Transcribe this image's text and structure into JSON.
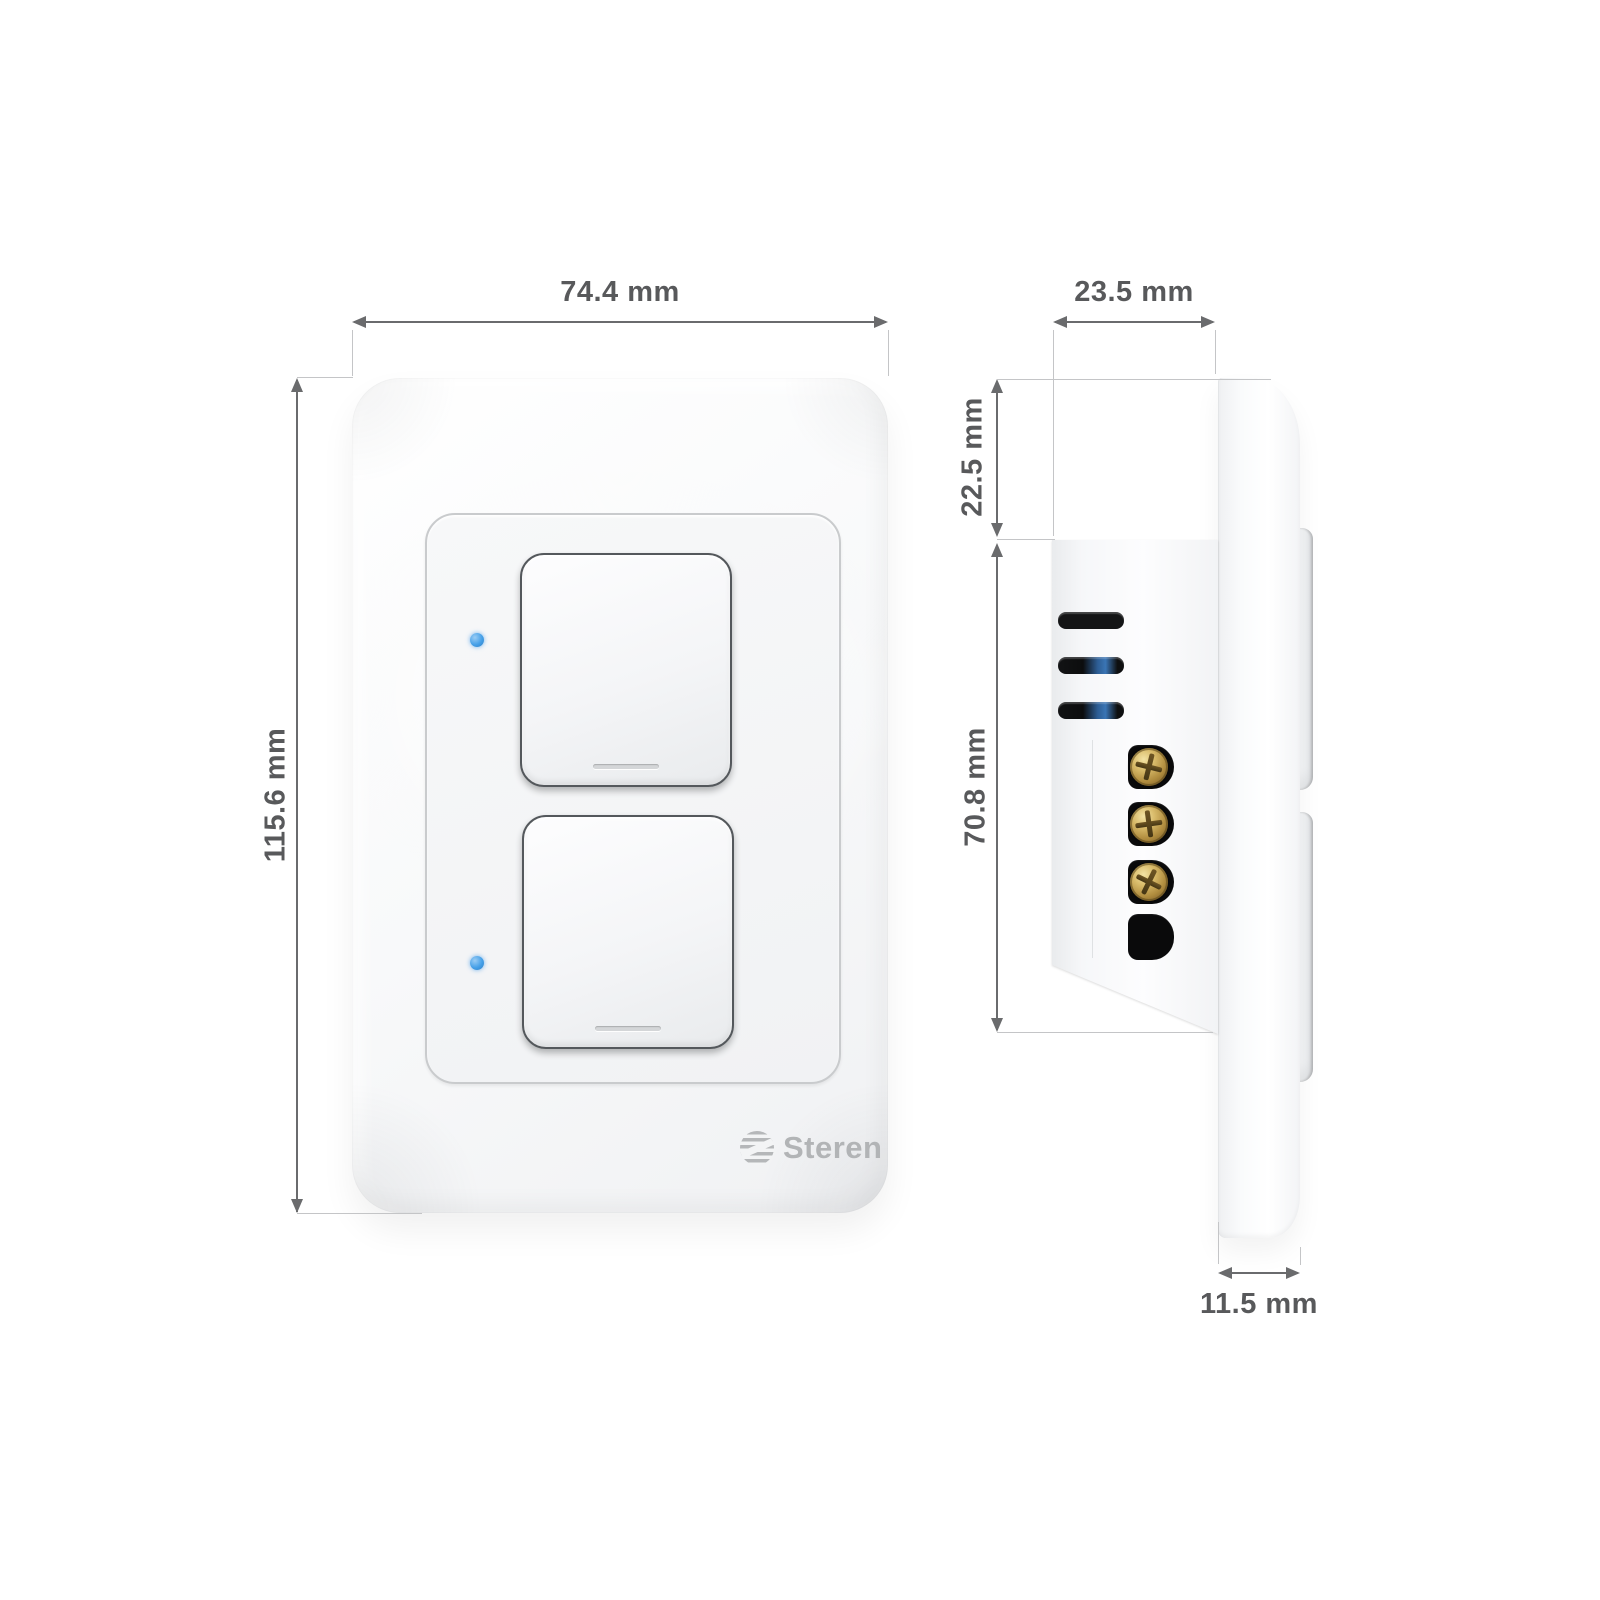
{
  "brand": {
    "name": "Steren"
  },
  "views": {
    "front": {
      "width_label": "74.4 mm",
      "height_label": "115.6 mm",
      "button_count": 2,
      "led_count": 2
    },
    "side": {
      "depth_label": "23.5 mm",
      "upper_section_label": "22.5 mm",
      "body_height_label": "70.8 mm",
      "plate_thickness_label": "11.5 mm",
      "vent_count": 3,
      "screw_count": 3,
      "terminal_slot_count": 4
    }
  },
  "colors": {
    "led_blue": "#45a0e8",
    "screw_brass": "#c9a855",
    "dimension_text": "#58595b",
    "plate_white": "#f5f6f8"
  },
  "icons": {
    "led": "led-indicator-dot",
    "screw": "phillips-screw-head",
    "globe": "steren-globe-logo",
    "arrow": "dimension-arrowhead"
  }
}
